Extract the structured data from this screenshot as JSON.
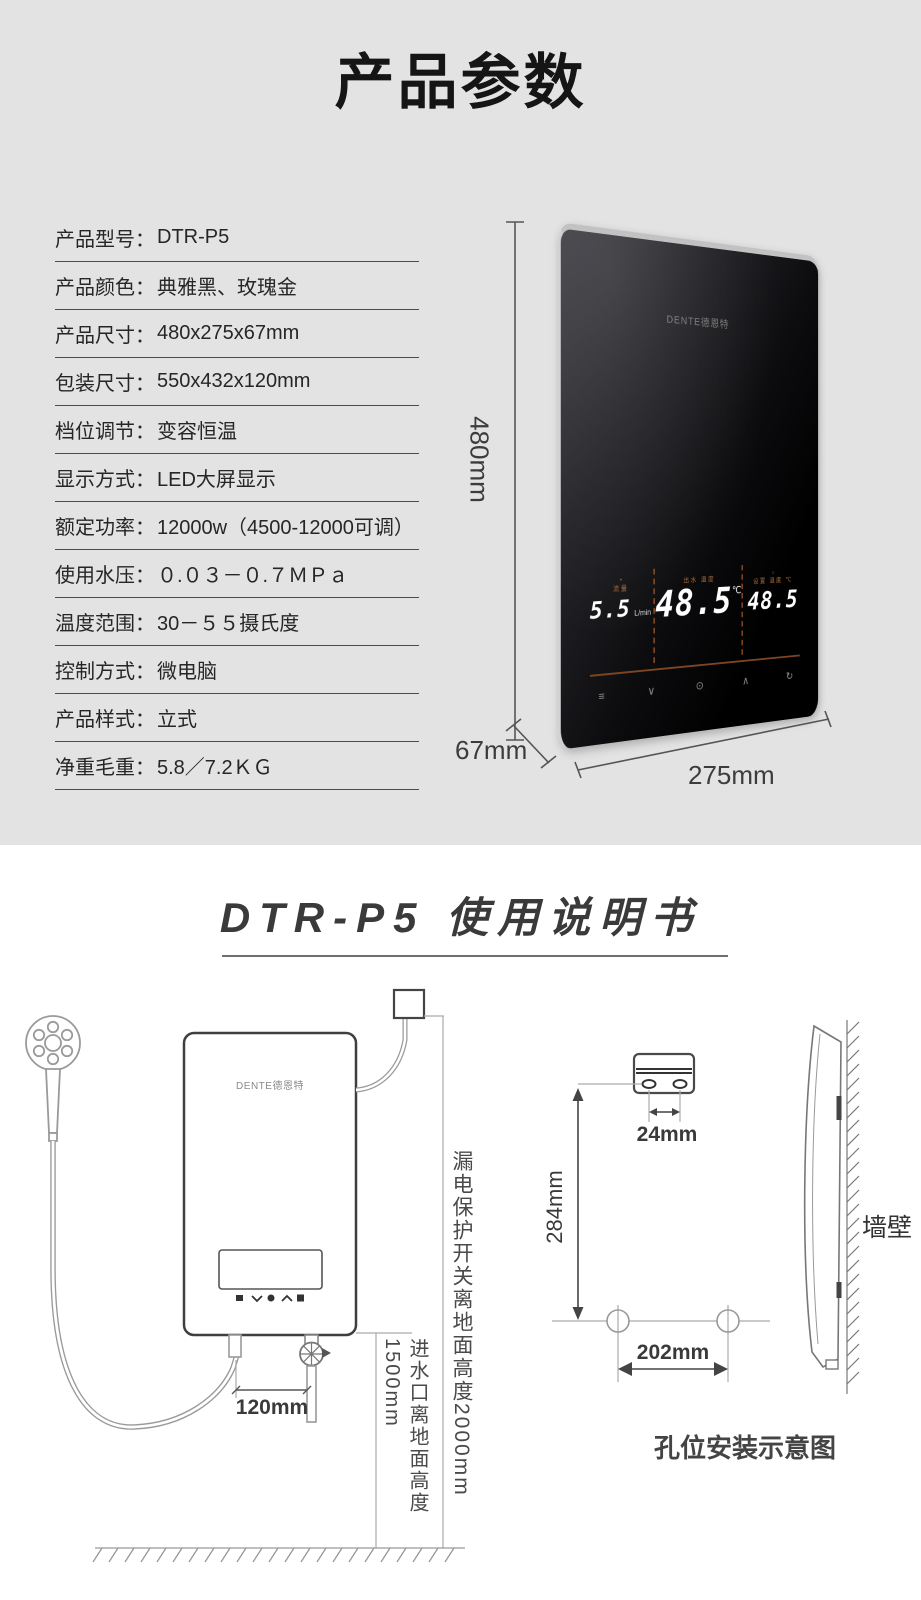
{
  "colors": {
    "top_bg": "#e3e3e3",
    "bottom_bg": "#ffffff",
    "display_accent": "#7d4520",
    "label_orange": "#b0703a"
  },
  "section_top": {
    "title": "产品参数",
    "specs": [
      {
        "label": "产品型号：",
        "value": "DTR-P5"
      },
      {
        "label": "产品颜色：",
        "value": "典雅黑、玫瑰金"
      },
      {
        "label": "产品尺寸：",
        "value": "480x275x67mm"
      },
      {
        "label": "包装尺寸：",
        "value": "550x432x120mm"
      },
      {
        "label": "档位调节：",
        "value": "变容恒温"
      },
      {
        "label": "显示方式：",
        "value": "LED大屏显示"
      },
      {
        "label": "额定功率：",
        "value": "12000w（4500-12000可调）"
      },
      {
        "label": "使用水压：",
        "value": "０.０３－０.７ＭＰａ"
      },
      {
        "label": "温度范围：",
        "value": "30－５５摄氏度"
      },
      {
        "label": "控制方式：",
        "value": "微电脑"
      },
      {
        "label": "产品样式：",
        "value": "立式"
      },
      {
        "label": "净重毛重：",
        "value": "5.8／7.2ＫＧ"
      }
    ],
    "dim_height": "480mm",
    "dim_depth": "67mm",
    "dim_width": "275mm",
    "product": {
      "logo": "DENTE德恩特",
      "display": {
        "flow_icon": "•",
        "flow_label": "流量",
        "flow_value": "5.5",
        "flow_unit": "L/min",
        "outlet_label": "出水 温度",
        "outlet_value": "48.5",
        "outlet_unit": "℃",
        "set_icon": "○",
        "set_label": "设置 温度 ℃",
        "set_value": "48.5",
        "buttons": [
          {
            "name": "menu",
            "glyph": "≡"
          },
          {
            "name": "down",
            "glyph": "∨"
          },
          {
            "name": "power",
            "glyph": "⊙"
          },
          {
            "name": "up",
            "glyph": "∧"
          },
          {
            "name": "mode",
            "glyph": "↻"
          }
        ]
      }
    }
  },
  "section_manual": {
    "title": "DTR-P5 使用说明书",
    "device_logo": "DENTE德恩特",
    "breaker_height_label": "漏电保护开关离地面高度2000mm",
    "inlet_height_label": "进水口离地面高度1500mm",
    "dim_pipe_spacing": "120mm",
    "dim_bracket_holes": "24mm",
    "dim_holes_vertical": "284mm",
    "dim_holes_horizontal": "202mm",
    "wall_label": "墙壁",
    "caption": "孔位安装示意图"
  }
}
